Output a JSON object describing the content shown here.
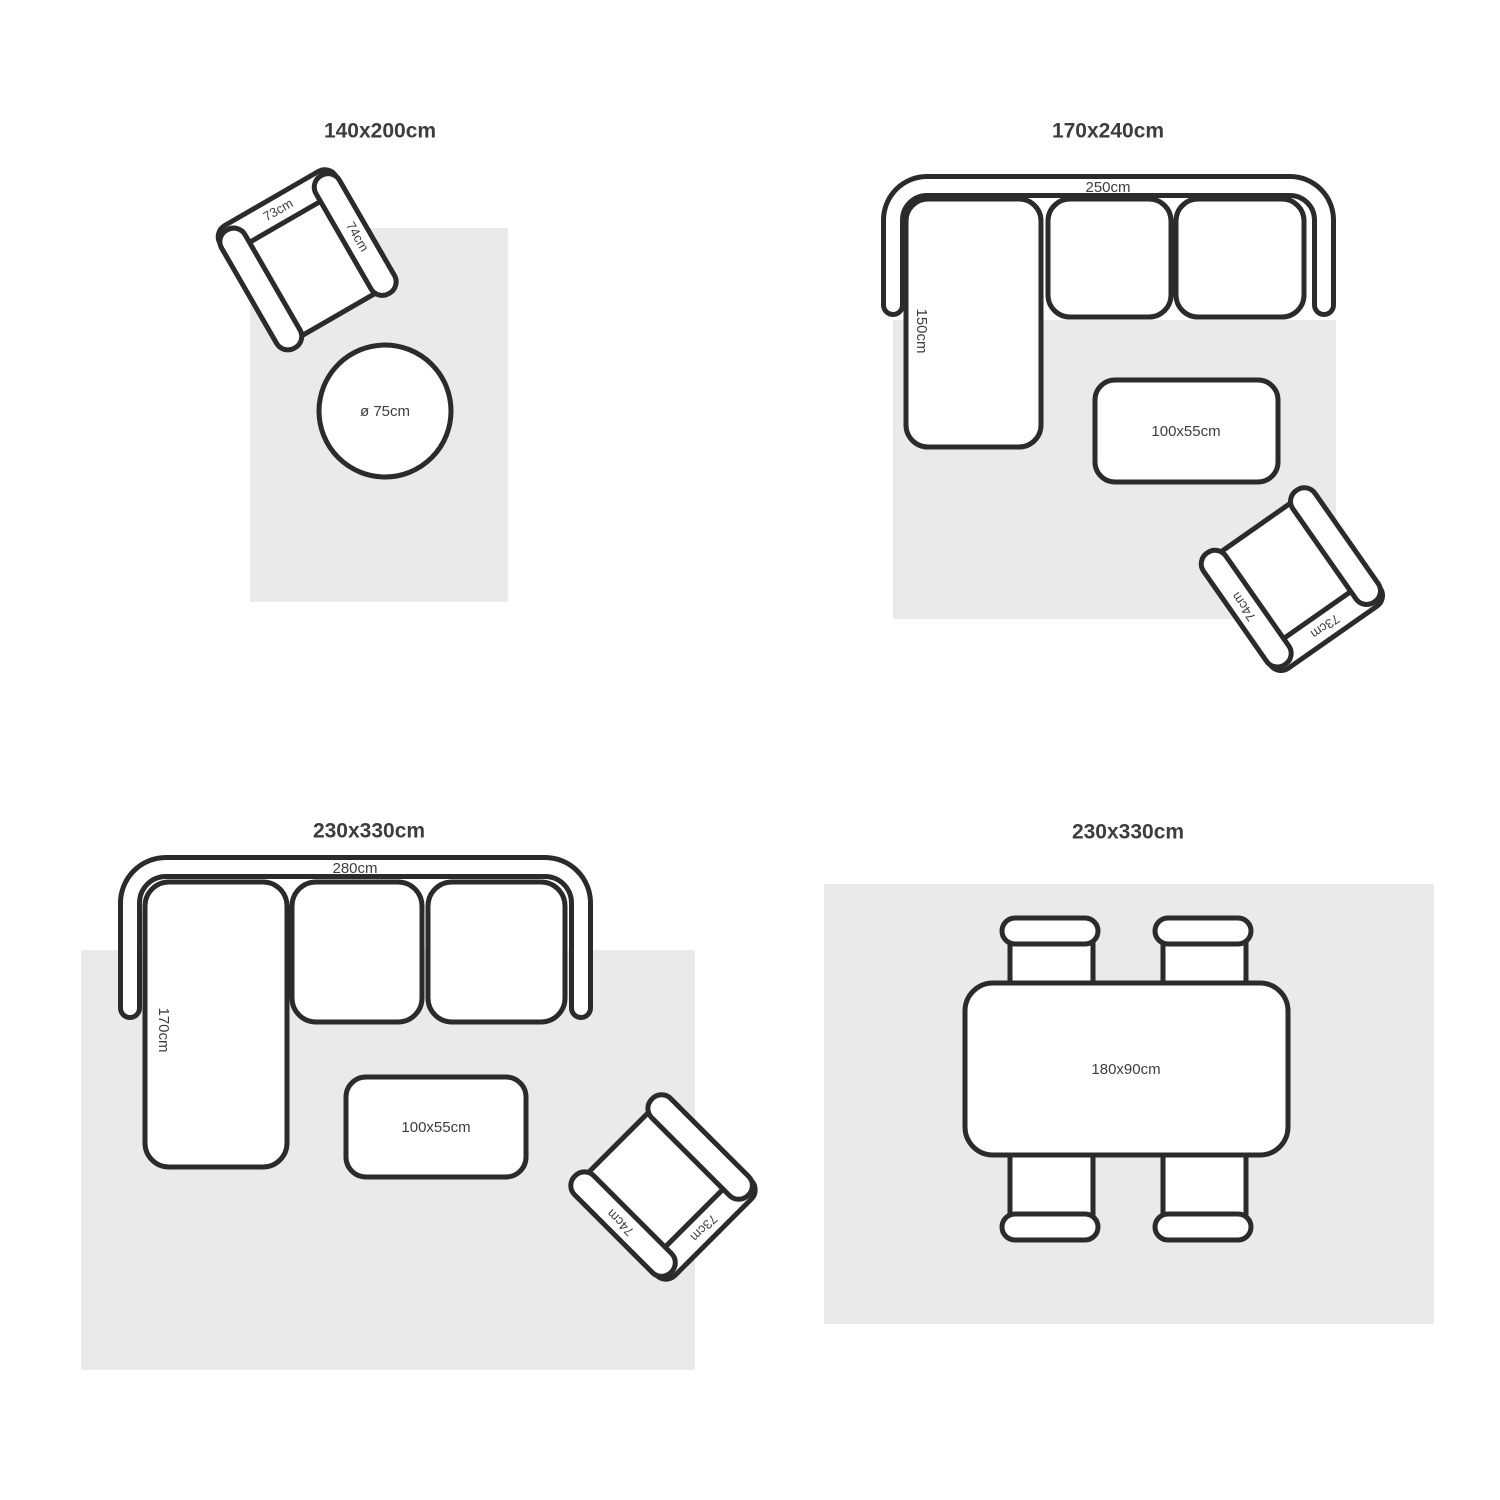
{
  "colors": {
    "background": "#ffffff",
    "rug": "#eaeaea",
    "outline": "#2b2b2b",
    "furniture_fill": "#ffffff",
    "label_text": "#3d3d3d"
  },
  "quadrants": [
    {
      "title": "140x200cm",
      "armchair": {
        "back": "73cm",
        "arm": "74cm"
      },
      "round_table": {
        "diameter": "ø 75cm"
      }
    },
    {
      "title": "170x240cm",
      "sofa": {
        "width": "250cm",
        "chaise": "150cm"
      },
      "coffee_table": {
        "size": "100x55cm"
      },
      "armchair": {
        "back": "73cm",
        "arm": "74cm"
      }
    },
    {
      "title": "230x330cm",
      "sofa": {
        "width": "280cm",
        "chaise": "170cm"
      },
      "coffee_table": {
        "size": "100x55cm"
      },
      "armchair": {
        "back": "73cm",
        "arm": "74cm"
      }
    },
    {
      "title": "230x330cm",
      "dining_table": {
        "size": "180x90cm"
      }
    }
  ]
}
